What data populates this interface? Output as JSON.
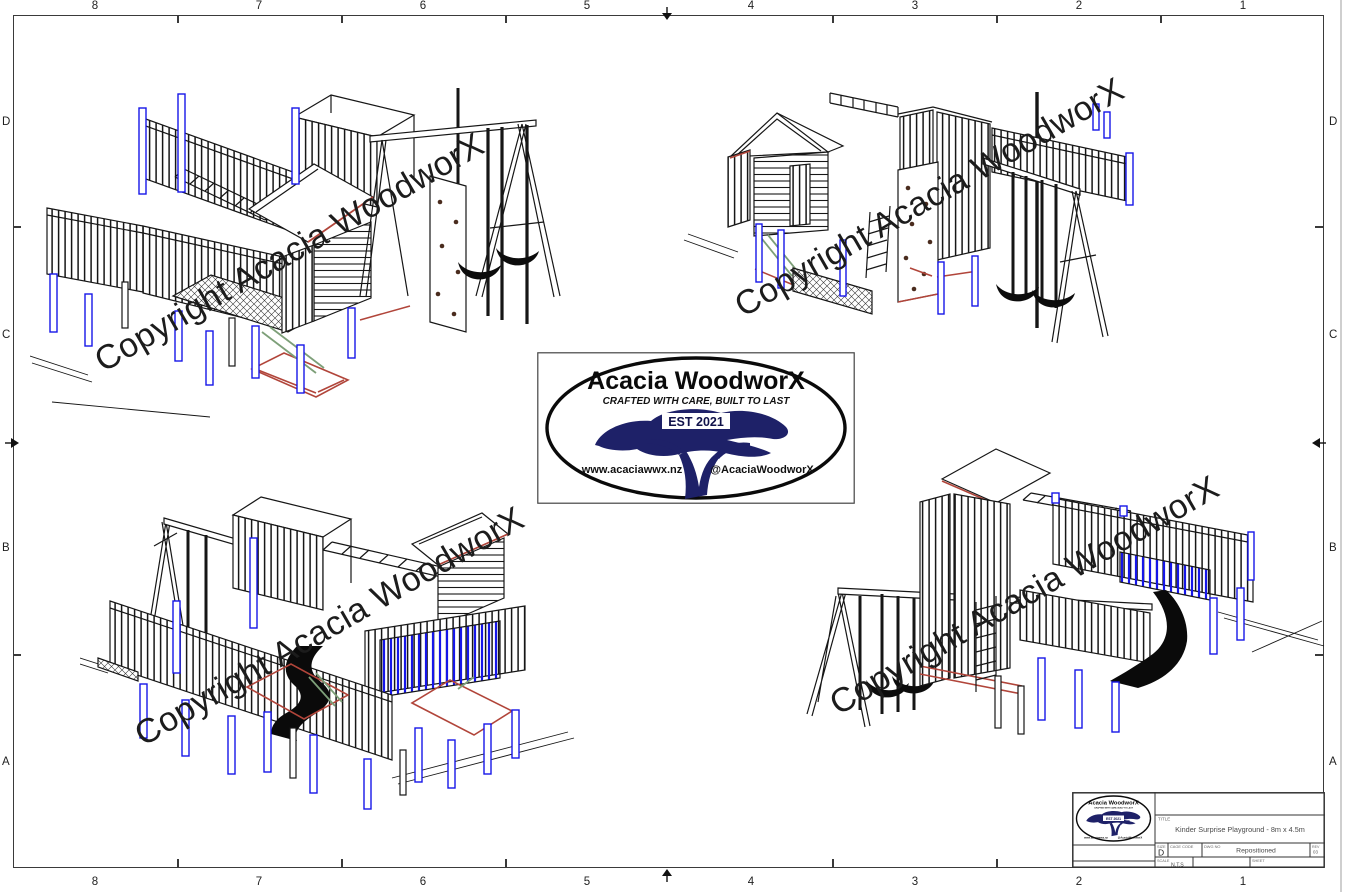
{
  "drawing": {
    "grid_cols": [
      "8",
      "7",
      "6",
      "5",
      "4",
      "3",
      "2",
      "1"
    ],
    "grid_rows": [
      "D",
      "C",
      "B",
      "A"
    ]
  },
  "watermark": {
    "text": "Copyright Acacia WoodworX"
  },
  "logo": {
    "brand": "Acacia WoodworX",
    "tagline": "CRAFTED WITH CARE, BUILT TO LAST",
    "established": "EST 2021",
    "website": "www.acaciawwx.nz",
    "social_handle": "@AcaciaWoodworX"
  },
  "title_block": {
    "labels": {
      "title": "TITLE",
      "size": "SIZE",
      "cage_code": "CAGE CODE",
      "dwg_no": "DWG NO",
      "rev": "REV",
      "scale": "SCALE",
      "sheet": "SHEET"
    },
    "title": "Kinder Surprise Playground - 8m x 4.5m",
    "size": "D",
    "dwg_no": "Repositioned",
    "rev": "03",
    "scale": "N.T.S",
    "sheet": ""
  },
  "colors": {
    "line": "#161616",
    "post_blue": "#1616e8",
    "trim_red": "#b1453a",
    "brace_green": "#7d9f78",
    "hold_brown": "#4a2c1e",
    "logo_navy": "#1e2168"
  }
}
